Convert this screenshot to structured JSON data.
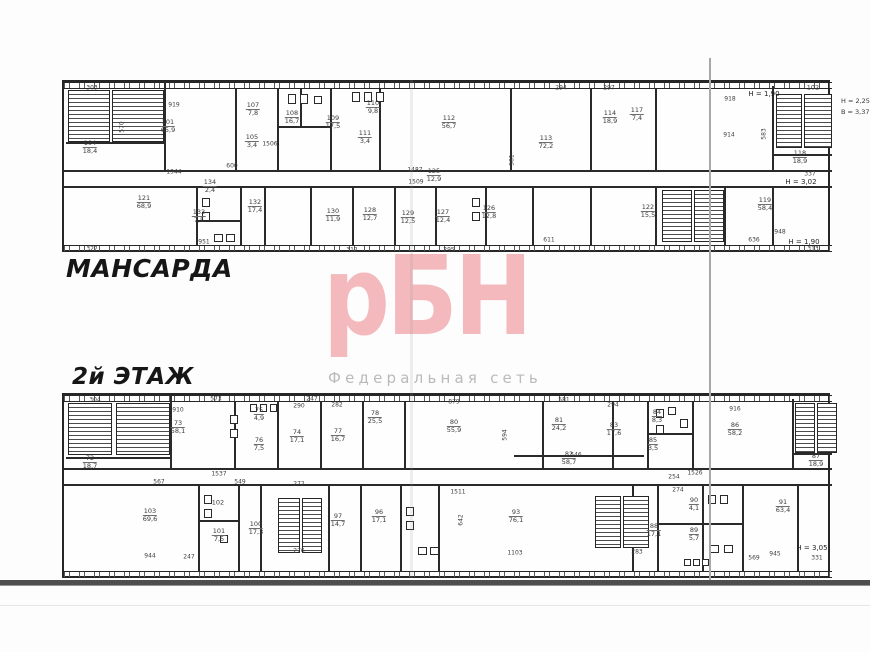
{
  "page": {
    "plan_labels": {
      "top": "МАНСАРДА",
      "bottom": "2й ЭТАЖ"
    },
    "watermark": {
      "logo": "рБН",
      "subtitle": "Федеральная сеть",
      "logo_color": "#f4b9bd",
      "subtitle_color": "#bababa"
    },
    "margin_annotations": {
      "line1": "Н = 2,25",
      "line2": "В = 3,37"
    }
  },
  "plans": [
    {
      "id": "plan-mansarda",
      "title": "МАНСАРДА",
      "rooms": [
        {
          "n": "104",
          "a": "18,4",
          "x": 26,
          "y": 66
        },
        {
          "n": "101",
          "a": "65,9",
          "x": 104,
          "y": 45
        },
        {
          "n": "107",
          "a": "7,8",
          "x": 189,
          "y": 28
        },
        {
          "n": "105",
          "a": "3,4",
          "x": 188,
          "y": 60
        },
        {
          "n": "108",
          "a": "16,7",
          "x": 228,
          "y": 36
        },
        {
          "n": "109",
          "a": "17,5",
          "x": 269,
          "y": 41
        },
        {
          "n": "110",
          "a": "9,8",
          "x": 309,
          "y": 26
        },
        {
          "n": "111",
          "a": "3,4",
          "x": 301,
          "y": 56
        },
        {
          "n": "112",
          "a": "56,7",
          "x": 385,
          "y": 41
        },
        {
          "n": "113",
          "a": "72,2",
          "x": 482,
          "y": 61
        },
        {
          "n": "114",
          "a": "18,9",
          "x": 546,
          "y": 36
        },
        {
          "n": "117",
          "a": "7,4",
          "x": 573,
          "y": 33
        },
        {
          "n": "102",
          "a": "",
          "x": 749,
          "y": 6
        },
        {
          "n": "118",
          "a": "18,9",
          "x": 736,
          "y": 76
        },
        {
          "n": "119",
          "a": "58,4",
          "x": 701,
          "y": 123
        },
        {
          "n": "121",
          "a": "68,9",
          "x": 80,
          "y": 121
        },
        {
          "n": "134",
          "a": "2,4",
          "x": 146,
          "y": 105
        },
        {
          "n": "133",
          "a": "7,5",
          "x": 135,
          "y": 135
        },
        {
          "n": "132",
          "a": "17,4",
          "x": 191,
          "y": 125
        },
        {
          "n": "130",
          "a": "11,9",
          "x": 269,
          "y": 134
        },
        {
          "n": "128",
          "a": "12,7",
          "x": 306,
          "y": 133
        },
        {
          "n": "129",
          "a": "12,5",
          "x": 344,
          "y": 136
        },
        {
          "n": "127",
          "a": "12,4",
          "x": 379,
          "y": 135
        },
        {
          "n": "126",
          "a": "12,8",
          "x": 425,
          "y": 131
        },
        {
          "n": "125",
          "a": "12,9",
          "x": 370,
          "y": 94
        },
        {
          "n": "122",
          "a": "15,5",
          "x": 584,
          "y": 130
        }
      ],
      "dims": [
        {
          "t": "303",
          "x": 28,
          "y": 6
        },
        {
          "t": "919",
          "x": 110,
          "y": 23
        },
        {
          "t": "570",
          "x": 58,
          "y": 45,
          "v": 1
        },
        {
          "t": "1506",
          "x": 206,
          "y": 62
        },
        {
          "t": "1944",
          "x": 110,
          "y": 90
        },
        {
          "t": "600",
          "x": 168,
          "y": 84
        },
        {
          "t": "1487",
          "x": 351,
          "y": 88
        },
        {
          "t": "1509",
          "x": 352,
          "y": 100
        },
        {
          "t": "581",
          "x": 448,
          "y": 78,
          "v": 1
        },
        {
          "t": "294",
          "x": 497,
          "y": 6
        },
        {
          "t": "297",
          "x": 545,
          "y": 6
        },
        {
          "t": "918",
          "x": 666,
          "y": 17
        },
        {
          "t": "914",
          "x": 665,
          "y": 53
        },
        {
          "t": "583",
          "x": 700,
          "y": 52,
          "v": 1
        },
        {
          "t": "337",
          "x": 746,
          "y": 92
        },
        {
          "t": "611",
          "x": 485,
          "y": 158
        },
        {
          "t": "636",
          "x": 690,
          "y": 158
        },
        {
          "t": "948",
          "x": 716,
          "y": 150
        },
        {
          "t": "322",
          "x": 28,
          "y": 167
        },
        {
          "t": "951",
          "x": 140,
          "y": 160
        },
        {
          "t": "312",
          "x": 288,
          "y": 168
        },
        {
          "t": "295",
          "x": 385,
          "y": 168
        },
        {
          "t": "313",
          "x": 749,
          "y": 167
        }
      ],
      "heights": [
        {
          "t": "Н = 1,90",
          "x": 700,
          "y": 12
        },
        {
          "t": "Н = 3,02",
          "x": 737,
          "y": 100
        },
        {
          "t": "Н = 1,90",
          "x": 740,
          "y": 160
        }
      ]
    },
    {
      "id": "plan-2nd-floor",
      "title": "2й ЭТАЖ",
      "rooms": [
        {
          "n": "72",
          "a": "18,7",
          "x": 26,
          "y": 68
        },
        {
          "n": "73",
          "a": "58,1",
          "x": 114,
          "y": 33
        },
        {
          "n": "75",
          "a": "4,9",
          "x": 195,
          "y": 20
        },
        {
          "n": "76",
          "a": "7,5",
          "x": 195,
          "y": 50
        },
        {
          "n": "74",
          "a": "17,1",
          "x": 233,
          "y": 42
        },
        {
          "n": "77",
          "a": "16,7",
          "x": 274,
          "y": 41
        },
        {
          "n": "78",
          "a": "25,5",
          "x": 311,
          "y": 23
        },
        {
          "n": "80",
          "a": "55,9",
          "x": 390,
          "y": 32
        },
        {
          "n": "81",
          "a": "24,2",
          "x": 495,
          "y": 30
        },
        {
          "n": "83",
          "a": "17,6",
          "x": 550,
          "y": 35
        },
        {
          "n": "82",
          "a": "58,7",
          "x": 505,
          "y": 64
        },
        {
          "n": "84",
          "a": "8,3",
          "x": 593,
          "y": 22
        },
        {
          "n": "85",
          "a": "3,5",
          "x": 589,
          "y": 50
        },
        {
          "n": "86",
          "a": "58,2",
          "x": 671,
          "y": 35
        },
        {
          "n": "87",
          "a": "18,9",
          "x": 752,
          "y": 66
        },
        {
          "n": "91",
          "a": "63,4",
          "x": 719,
          "y": 112
        },
        {
          "n": "90",
          "a": "4,1",
          "x": 630,
          "y": 110
        },
        {
          "n": "89",
          "a": "5,7",
          "x": 630,
          "y": 140
        },
        {
          "n": "88",
          "a": "17,1",
          "x": 590,
          "y": 136
        },
        {
          "n": "93",
          "a": "76,1",
          "x": 452,
          "y": 122
        },
        {
          "n": "96",
          "a": "17,1",
          "x": 315,
          "y": 122
        },
        {
          "n": "97",
          "a": "14,7",
          "x": 274,
          "y": 126
        },
        {
          "n": "103",
          "a": "69,6",
          "x": 86,
          "y": 121
        },
        {
          "n": "102",
          "a": "",
          "x": 154,
          "y": 108
        },
        {
          "n": "101",
          "a": "7,5",
          "x": 155,
          "y": 141
        },
        {
          "n": "100",
          "a": "17,3",
          "x": 192,
          "y": 134
        }
      ],
      "dims": [
        {
          "t": "304",
          "x": 31,
          "y": 5
        },
        {
          "t": "573",
          "x": 152,
          "y": 4
        },
        {
          "t": "247",
          "x": 248,
          "y": 4
        },
        {
          "t": "910",
          "x": 114,
          "y": 15
        },
        {
          "t": "290",
          "x": 235,
          "y": 11
        },
        {
          "t": "282",
          "x": 273,
          "y": 10
        },
        {
          "t": "879",
          "x": 390,
          "y": 7
        },
        {
          "t": "581",
          "x": 500,
          "y": 5
        },
        {
          "t": "294",
          "x": 549,
          "y": 10
        },
        {
          "t": "916",
          "x": 671,
          "y": 14
        },
        {
          "t": "594",
          "x": 441,
          "y": 40,
          "v": 1
        },
        {
          "t": "567",
          "x": 95,
          "y": 87
        },
        {
          "t": "1537",
          "x": 155,
          "y": 79
        },
        {
          "t": "549",
          "x": 176,
          "y": 87
        },
        {
          "t": "272",
          "x": 235,
          "y": 89
        },
        {
          "t": "1511",
          "x": 394,
          "y": 97
        },
        {
          "t": "1526",
          "x": 631,
          "y": 78
        },
        {
          "t": "546",
          "x": 512,
          "y": 60
        },
        {
          "t": "254",
          "x": 610,
          "y": 82
        },
        {
          "t": "274",
          "x": 614,
          "y": 95
        },
        {
          "t": "642",
          "x": 397,
          "y": 125,
          "v": 1
        },
        {
          "t": "944",
          "x": 86,
          "y": 161
        },
        {
          "t": "247",
          "x": 125,
          "y": 162
        },
        {
          "t": "276",
          "x": 235,
          "y": 156
        },
        {
          "t": "1103",
          "x": 451,
          "y": 158
        },
        {
          "t": "283",
          "x": 573,
          "y": 157
        },
        {
          "t": "569",
          "x": 690,
          "y": 163
        },
        {
          "t": "945",
          "x": 711,
          "y": 159
        },
        {
          "t": "331",
          "x": 753,
          "y": 163
        }
      ],
      "heights": [
        {
          "t": "Н = 3,05",
          "x": 748,
          "y": 153
        }
      ]
    }
  ]
}
